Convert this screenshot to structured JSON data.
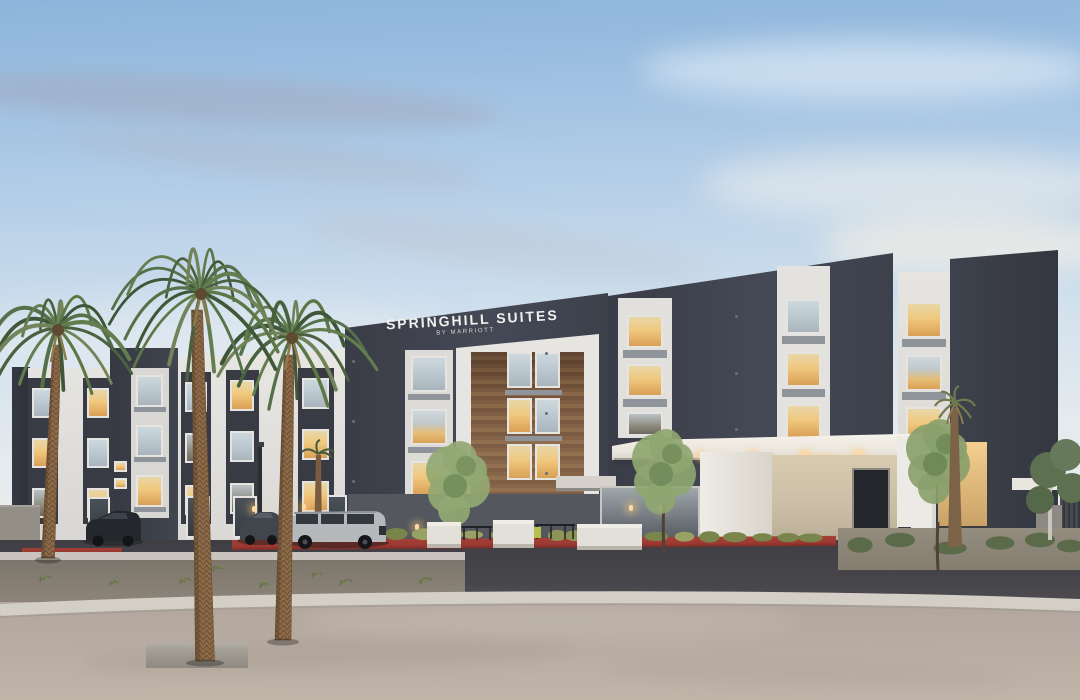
{
  "image": {
    "kind": "photograph",
    "subject": "SpringHill Suites by Marriott hotel exterior at dusk",
    "setting": "four-story modern hotel with charcoal and white facade, wood-panel center bay, entrance canopy, palm trees, parked cars and an empty paved forecourt"
  },
  "signage": {
    "brand": "SPRINGHILL SUITES",
    "sub_brand": "BY MARRIOTT"
  },
  "colors": {
    "sky_top": "#8cb4da",
    "sky_horizon": "#eae6df",
    "facade_dark": "#3f434e",
    "facade_light": "#e2e0dc",
    "wood_panel": "#7d5c42",
    "entry_stone": "#c9bda6",
    "canopy_white": "#f2efe9",
    "road_asphalt": "#47464b",
    "curb_red": "#9e3a32",
    "curb_white": "#d3cfc7",
    "forecourt": "#b8aca2",
    "palm_frond": "#54714a",
    "palm_trunk": "#8d6b49",
    "tree_green": "#8fa671",
    "window_lit": "#f0c87e",
    "window_sky": "#c9d4da"
  }
}
